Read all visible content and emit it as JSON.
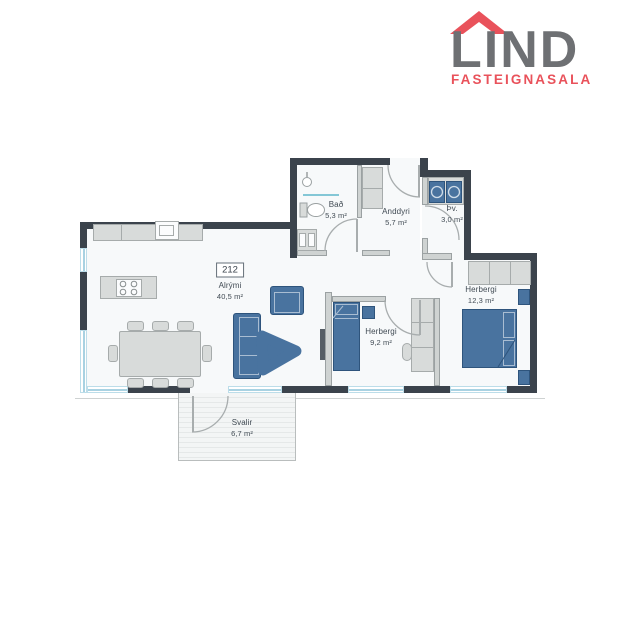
{
  "brand": {
    "name": "LIND",
    "tagline": "FASTEIGNASALA"
  },
  "floorplan": {
    "unit_number": "212",
    "rooms": [
      {
        "name": "Alrými",
        "area": "40,5 m²"
      },
      {
        "name": "Bað",
        "area": "5,3 m²"
      },
      {
        "name": "Anddyri",
        "area": "5,7 m²"
      },
      {
        "name": "Þv.",
        "area": "3,0 m²"
      },
      {
        "name": "Herbergi",
        "area": "9,2 m²"
      },
      {
        "name": "Herbergi",
        "area": "12,3 m²"
      },
      {
        "name": "Svalir",
        "area": "6,7 m²"
      }
    ],
    "colors": {
      "exterior_wall": "#3b434c",
      "interior_wall": "#cfd3d2",
      "furniture_blue": "#49739f",
      "furniture_gray": "#d8dbda",
      "window_blue": "#a9d2e2",
      "room_fill": "#f7f9fa",
      "logo_gray": "#6e7073",
      "logo_red": "#e9525b"
    }
  }
}
